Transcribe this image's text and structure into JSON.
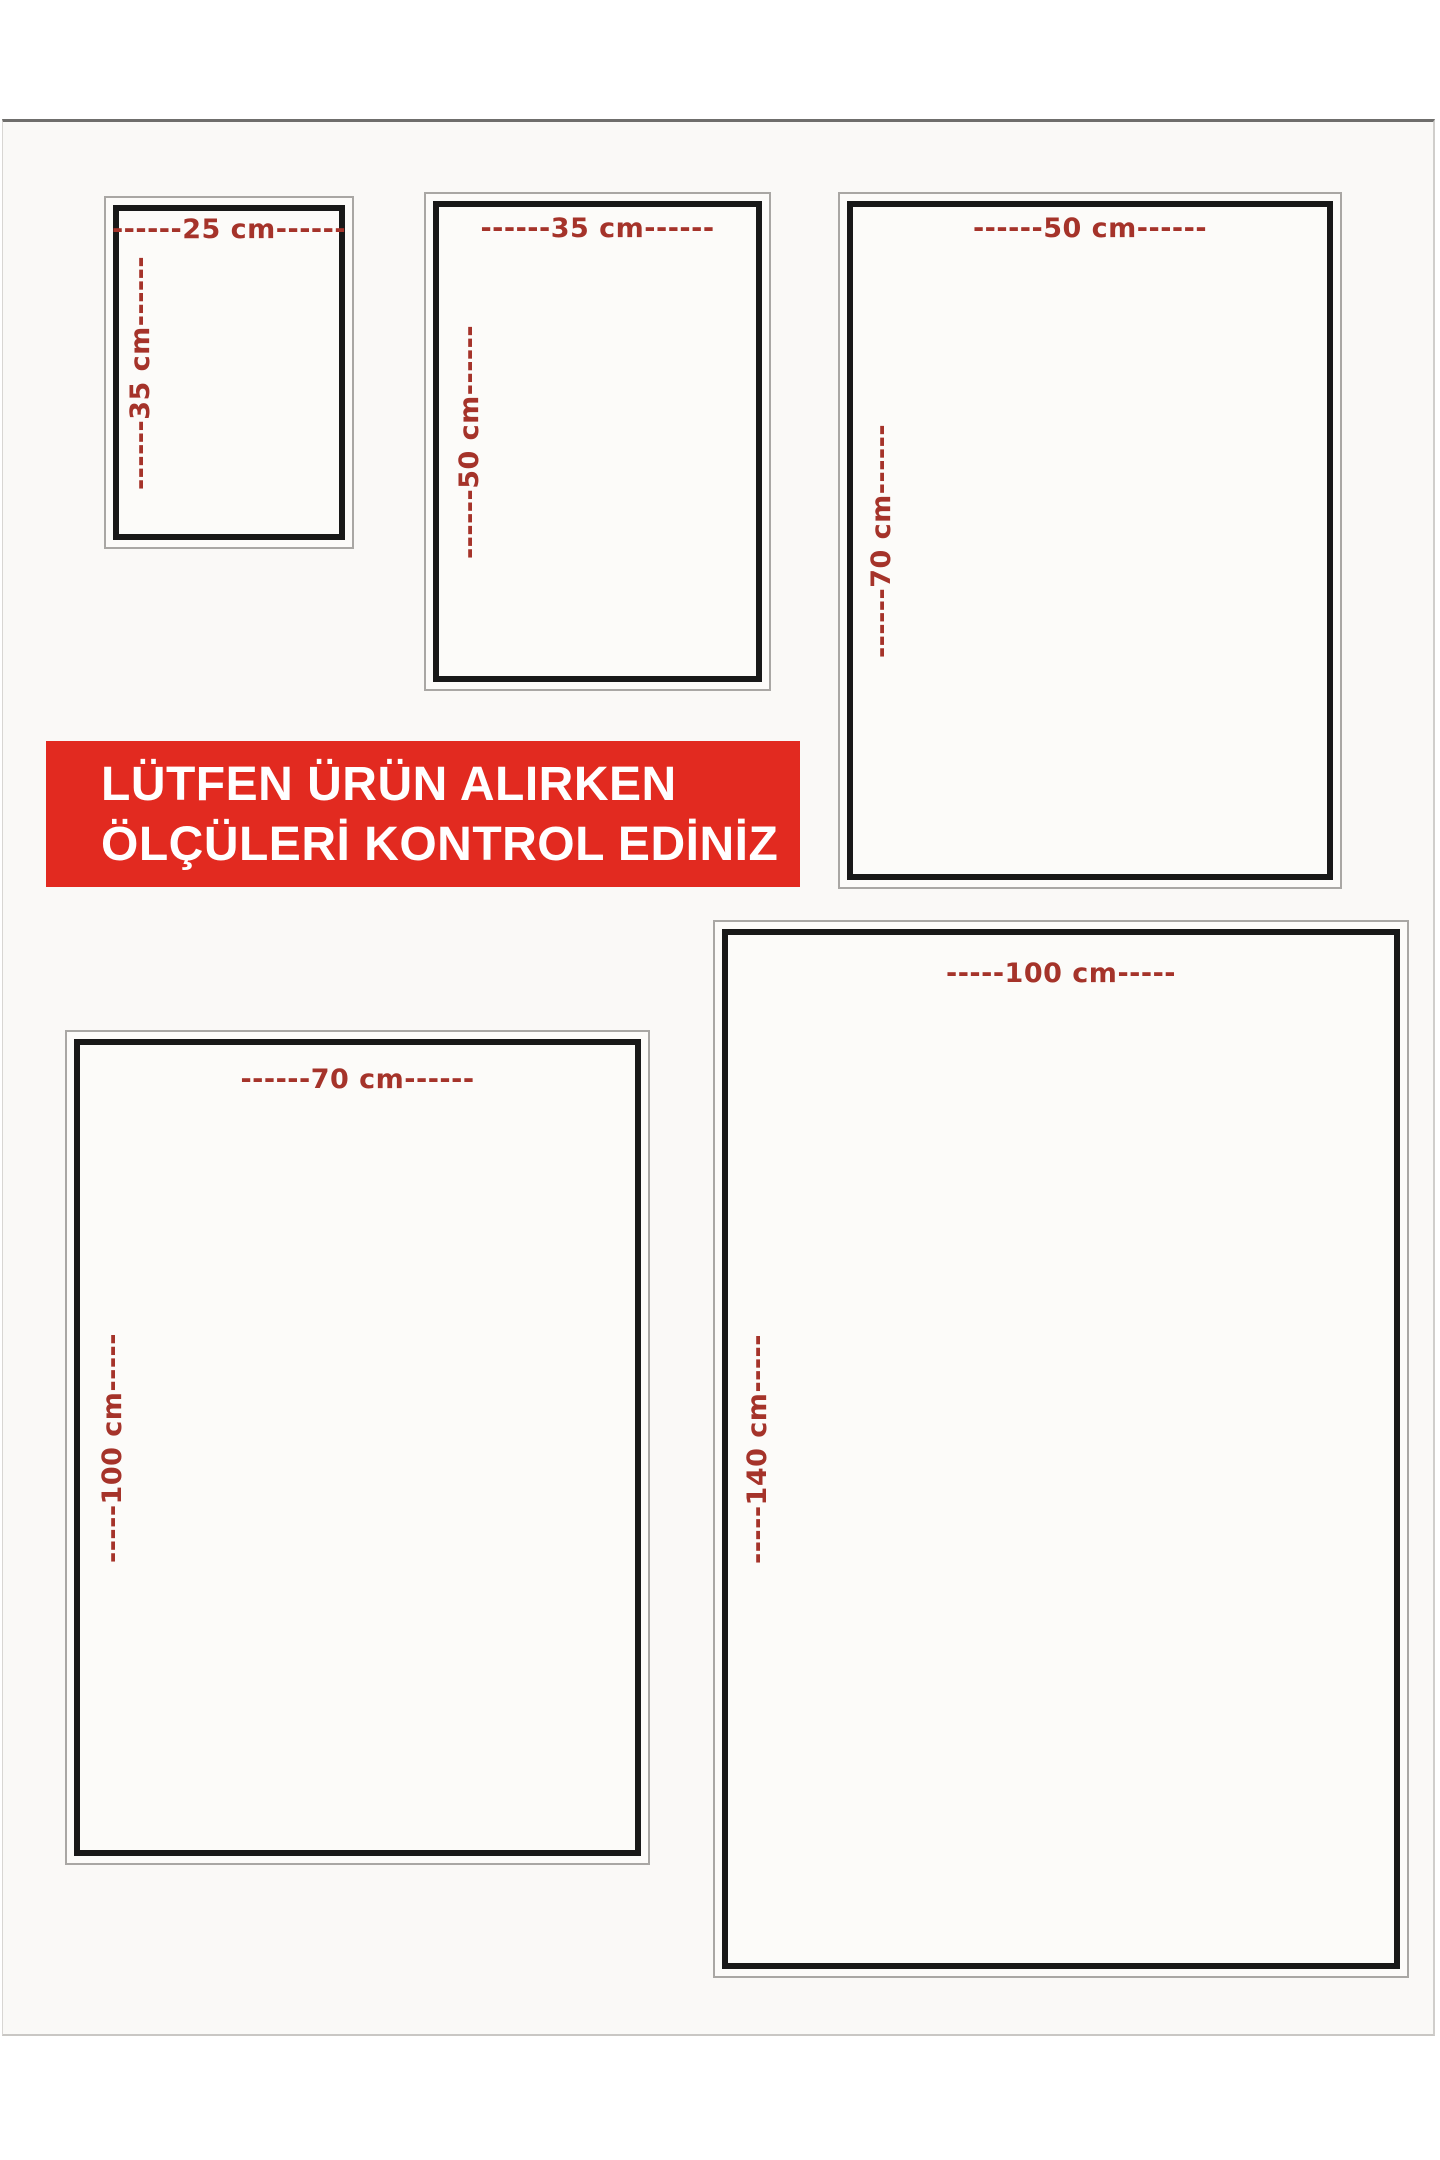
{
  "notice": {
    "line1": "LÜTFEN ÜRÜN ALIRKEN",
    "line2": "ÖLÇÜLERİ KONTROL EDİNİZ"
  },
  "unit": "cm",
  "size_boxes": [
    {
      "name": "25x35",
      "width_cm": 25,
      "height_cm": 35,
      "width_label": "------25 cm------",
      "height_label": "------35 cm------"
    },
    {
      "name": "35x50",
      "width_cm": 35,
      "height_cm": 50,
      "width_label": "------35 cm------",
      "height_label": "------50 cm------"
    },
    {
      "name": "50x70",
      "width_cm": 50,
      "height_cm": 70,
      "width_label": "------50 cm------",
      "height_label": "------70 cm------"
    },
    {
      "name": "70x100",
      "width_cm": 70,
      "height_cm": 100,
      "width_label": "------70 cm------",
      "height_label": "-----100 cm-----"
    },
    {
      "name": "100x140",
      "width_cm": 100,
      "height_cm": 140,
      "width_label": "-----100 cm-----",
      "height_label": "-----140 cm-----"
    }
  ],
  "colors": {
    "dimension_text": "#a5332a",
    "notice_background": "#e22a20",
    "notice_text": "#ffffff",
    "frame_border": "#181818",
    "outer_border": "#a9a7a4",
    "sheet_background": "#faf9f7"
  }
}
